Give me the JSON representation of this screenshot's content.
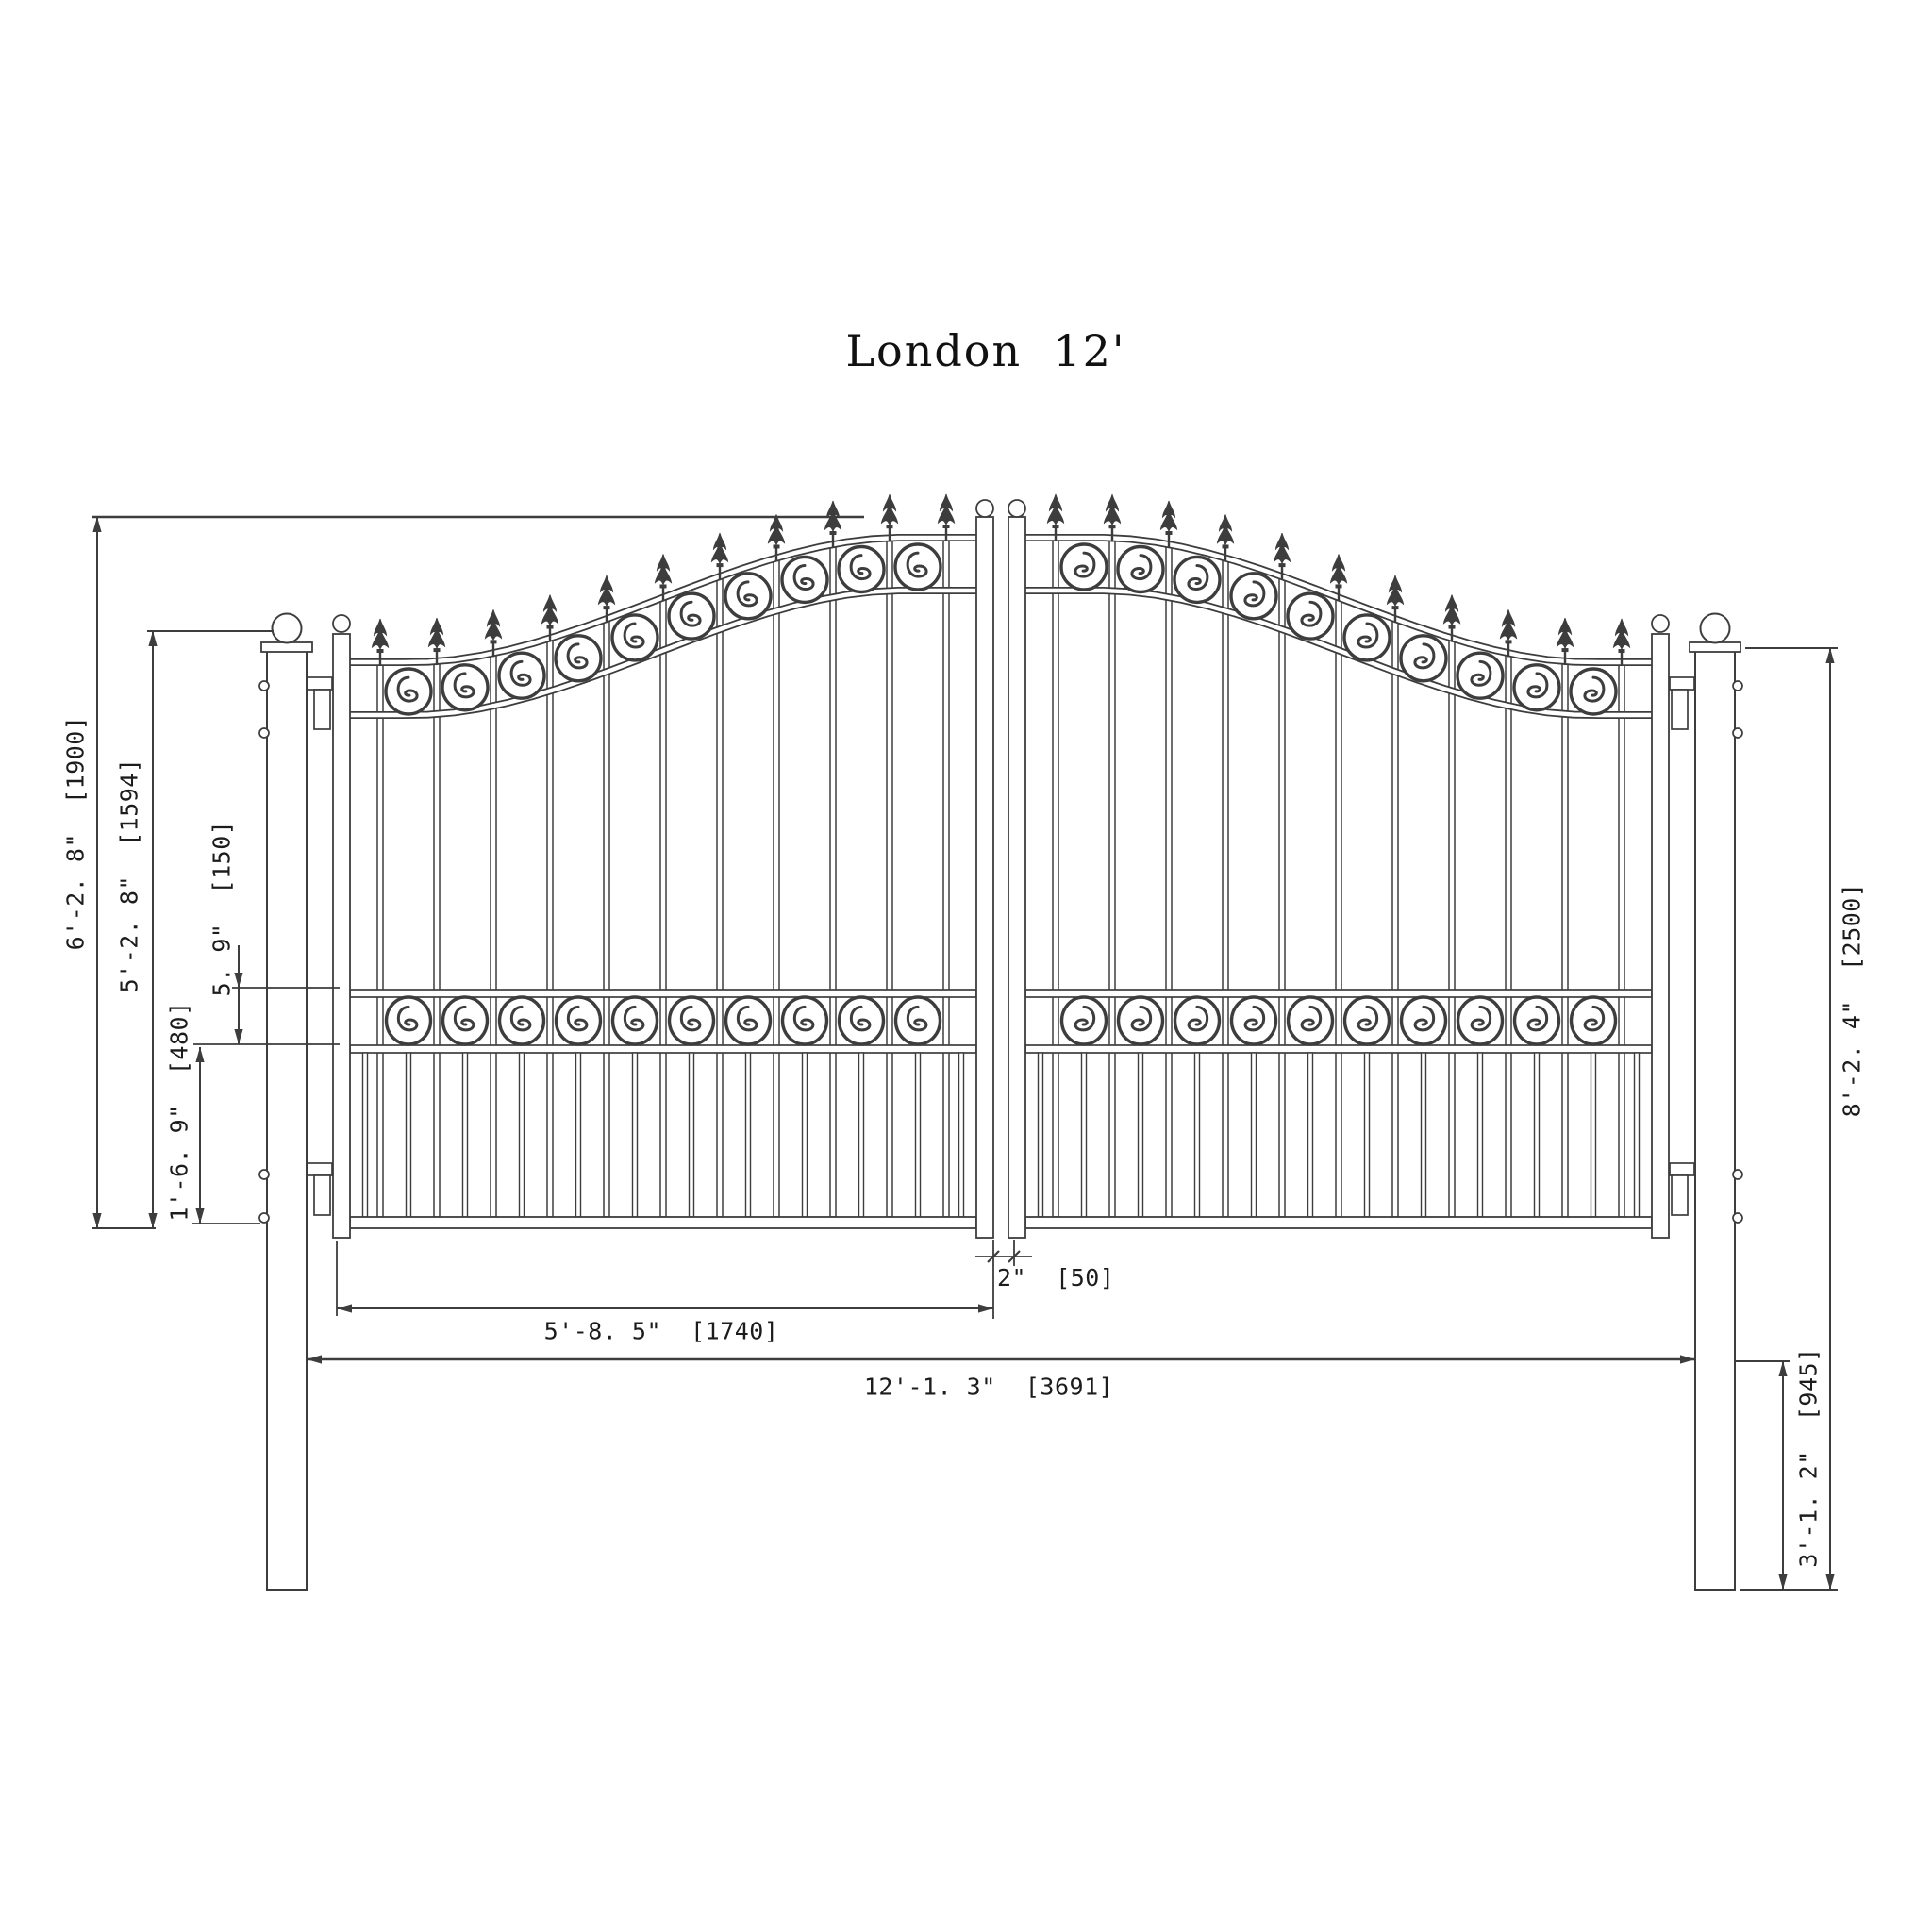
{
  "title": "London  12'",
  "colors": {
    "line": "#3d3d3d",
    "text": "#1c1c1c",
    "background": "#ffffff"
  },
  "dimensions": {
    "total_height": "6'-2. 8\"  [1900]",
    "side_height": "5'-2. 8\"  [1594]",
    "scroll_band_height": "5. 9\"  [150]",
    "lower_section_height": "1'-6. 9\"  [480]",
    "post_height": "8'-2. 4\"  [2500]",
    "post_buried_depth": "3'-1. 2\"  [945]",
    "leaf_gap": "2\"  [50]",
    "leaf_width": "5'-8. 5\"  [1740]",
    "overall_width": "12'-1. 3\"  [3691]"
  }
}
